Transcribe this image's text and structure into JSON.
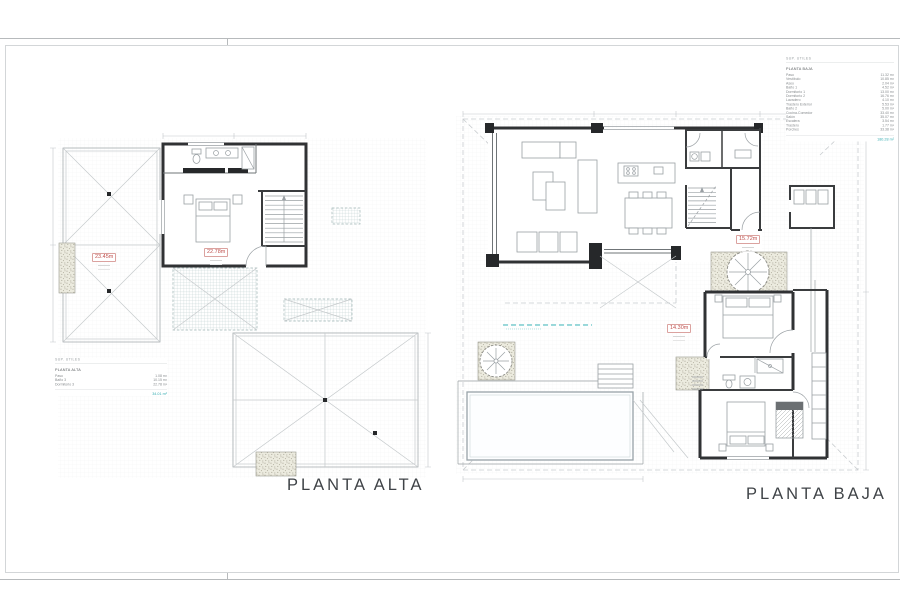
{
  "plan_titles": {
    "alta": "PLANTA ALTA",
    "baja": "PLANTA BAJA"
  },
  "legend_alta": {
    "header": "SUP. UTILES",
    "title": "PLANTA ALTA",
    "rows": [
      {
        "label": "Paso",
        "value": "1.08 m²"
      },
      {
        "label": "Baño 3",
        "value": "10.15 m²"
      },
      {
        "label": "Dormitorio 3",
        "value": "22.78 m²"
      }
    ],
    "total": "34.01 m²"
  },
  "legend_baja": {
    "header": "SUP. UTILES",
    "title": "PLANTA BAJA",
    "rows": [
      {
        "label": "Paso",
        "value": "11.32 m²"
      },
      {
        "label": "Vestíbulo",
        "value": "10.85 m²"
      },
      {
        "label": "Aseo",
        "value": "2.04 m²"
      },
      {
        "label": "Baño 1",
        "value": "4.52 m²"
      },
      {
        "label": "Dormitorio 1",
        "value": "13.00 m²"
      },
      {
        "label": "Dormitorio 2",
        "value": "16.76 m²"
      },
      {
        "label": "Lavadero",
        "value": "4.10 m²"
      },
      {
        "label": "Trastero Exterior",
        "value": "5.53 m²"
      },
      {
        "label": "Baño 2",
        "value": "5.00 m²"
      },
      {
        "label": "Cocina-Comedor",
        "value": "33.40 m²"
      },
      {
        "label": "Salón",
        "value": "35.07 m²"
      },
      {
        "label": "Escalera",
        "value": "3.54 m²"
      },
      {
        "label": "Trastero",
        "value": "1.77 m²"
      },
      {
        "label": "Porches",
        "value": "33.38 m²"
      }
    ],
    "total": "180.28 m²"
  },
  "area_labels": {
    "alta_roof": "23.45m",
    "alta_dorm3": "22.78m",
    "baja_paso": "15.72m",
    "baja_dorm": "14.30m"
  },
  "colors": {
    "accent_teal": "#3ab0b5",
    "label_red": "#bf4f4c",
    "wall": "#303234",
    "light_line": "#c6cacc"
  }
}
